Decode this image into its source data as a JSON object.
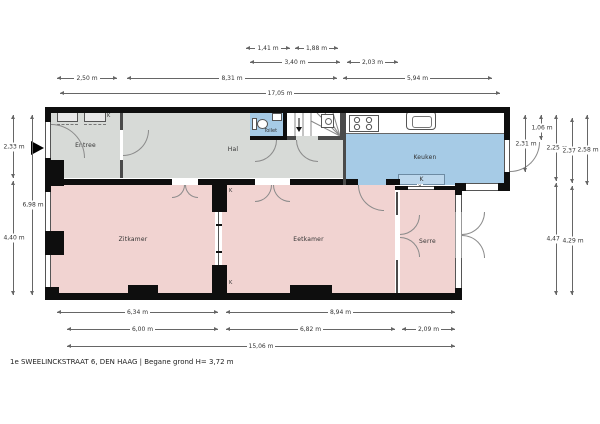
{
  "title": {
    "caption": "1e SWEELINCKSTRAAT 6, DEN HAAG | Begane grond H= 3,72 m"
  },
  "rooms": {
    "entree": "Entree",
    "hal": "Hal",
    "toilet": "Toilet",
    "keuken": "Keuken",
    "zitkamer": "Zitkamer",
    "eetkamer": "Eetkamer",
    "serre": "Serre"
  },
  "markers": {
    "boiler": "K",
    "window_marker": "x",
    "meter": "K",
    "closet_top": "K",
    "closet_bottom": "K"
  },
  "colors": {
    "room_gray": "#d7dad7",
    "room_pink": "#f1d3d1",
    "room_blue": "#a6cbe6",
    "counter_blue": "#bcd7ec",
    "wall": "#0e0e0e"
  },
  "dims": {
    "t1a": "1,41 m",
    "t1b": "1,88 m",
    "t2a": "3,40 m",
    "t2b": "2,03 m",
    "t3a": "2,50 m",
    "t3b": "8,31 m",
    "t3c": "5,94 m",
    "t4": "17,05 m",
    "b1a": "6,34 m",
    "b1b": "8,94 m",
    "b2a": "6,00 m",
    "b2b": "6,82 m",
    "b2c": "2,09 m",
    "b3": "15,06 m",
    "l1a": "2,33 m",
    "l1b": "4,40 m",
    "l2": "6,98 m",
    "r1": "2,31 m",
    "r2": "1,06 m",
    "r3a": "2,25 m",
    "r3b": "4,47 m",
    "r4a": "2,37 m",
    "r4b": "4,29 m",
    "r5": "2,58 m"
  }
}
